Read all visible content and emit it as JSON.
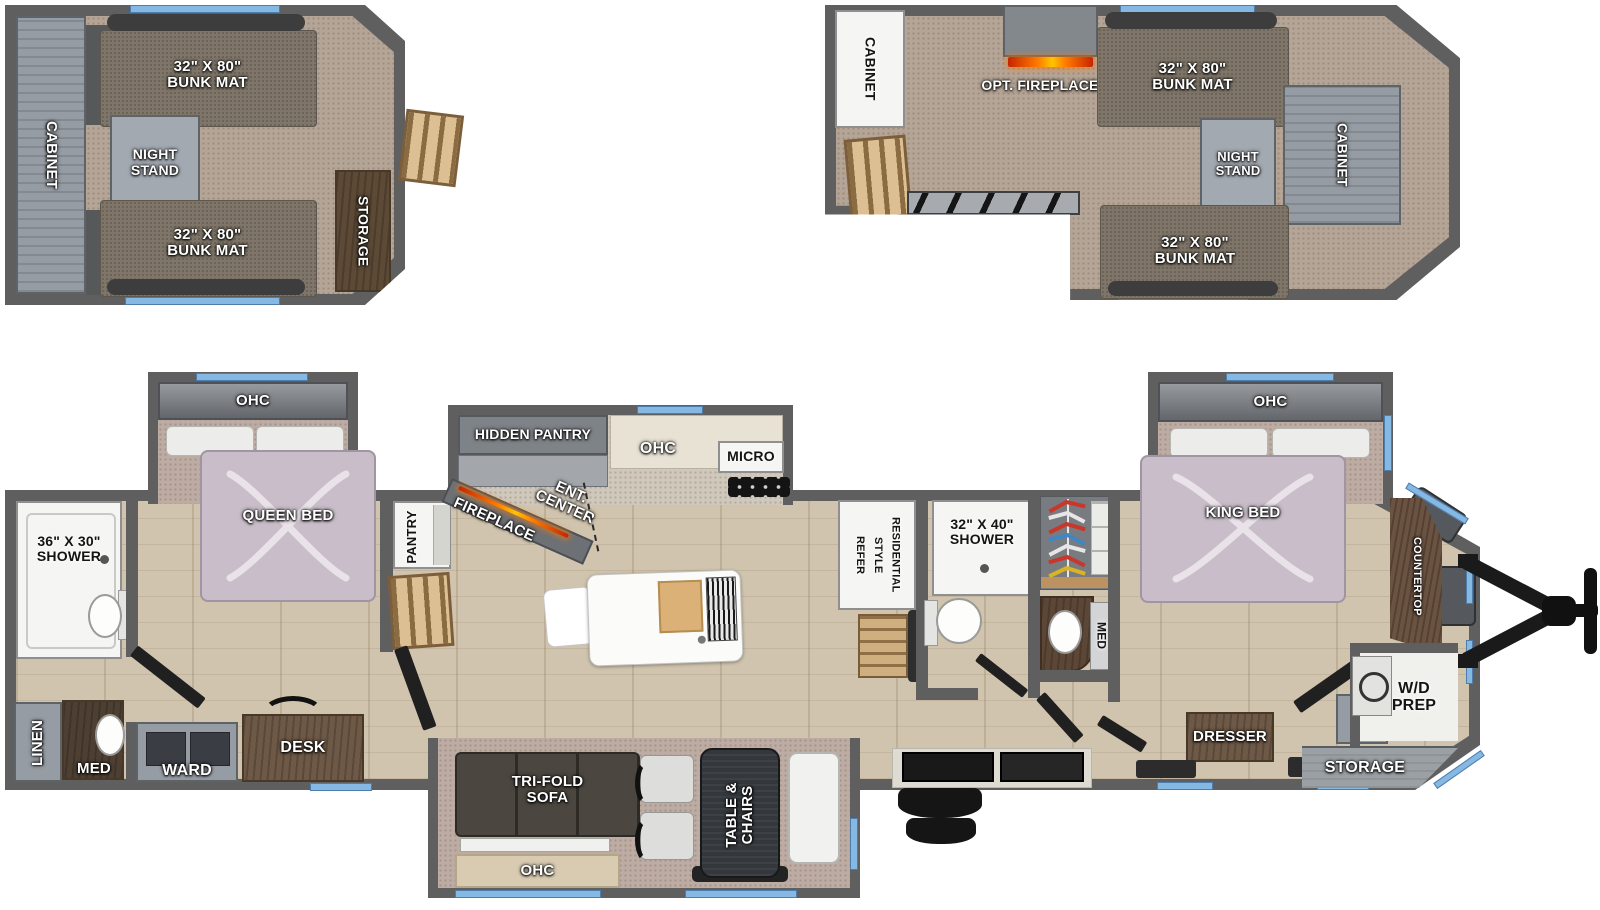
{
  "colors": {
    "wall": "#5f5f5f",
    "window_accent": "#86b8e4",
    "flame": "#ff7a00",
    "floor_wood": "#d0c4ae",
    "carpet": "#b5a597"
  },
  "loft_rear": {
    "cabinet": "CABINET",
    "bunk_top": "32\" X 80\"\nBUNK MAT",
    "night_stand": "NIGHT\nSTAND",
    "bunk_bottom": "32\" X 80\"\nBUNK MAT",
    "storage": "STORAGE"
  },
  "loft_front": {
    "cabinet_left": "CABINET",
    "opt_fireplace": "OPT. FIREPLACE",
    "bunk_top": "32\" X 80\"\nBUNK MAT",
    "night_stand": "NIGHT\nSTAND",
    "cabinet_right": "CABINET",
    "bunk_bottom": "32\" X 80\"\nBUNK MAT"
  },
  "rear_bath": {
    "shower": "36\" X 30\"\nSHOWER",
    "linen": "LINEN",
    "med": "MED"
  },
  "rear_bedroom": {
    "ohc": "OHC",
    "bed": "QUEEN BED",
    "ward": "WARD",
    "desk": "DESK"
  },
  "kitchen": {
    "pantry": "PANTRY",
    "hidden_pantry": "HIDDEN PANTRY",
    "ohc": "OHC",
    "micro": "MICRO",
    "ent_center": "ENT. CENTER",
    "fireplace": "FIREPLACE"
  },
  "living": {
    "sofa": "TRI-FOLD\nSOFA",
    "ohc": "OHC",
    "table_chairs": "TABLE &\nCHAIRS"
  },
  "mid_bath": {
    "refer": "RESIDENTIAL\nSTYLE\nREFER",
    "shower": "32\" X 40\"\nSHOWER",
    "med": "MED"
  },
  "front_bedroom": {
    "ohc": "OHC",
    "bed": "KING BED",
    "dresser": "DRESSER"
  },
  "front_cap": {
    "countertop": "COUNTERTOP",
    "wd_prep": "W/D\nPREP",
    "storage": "STORAGE"
  }
}
